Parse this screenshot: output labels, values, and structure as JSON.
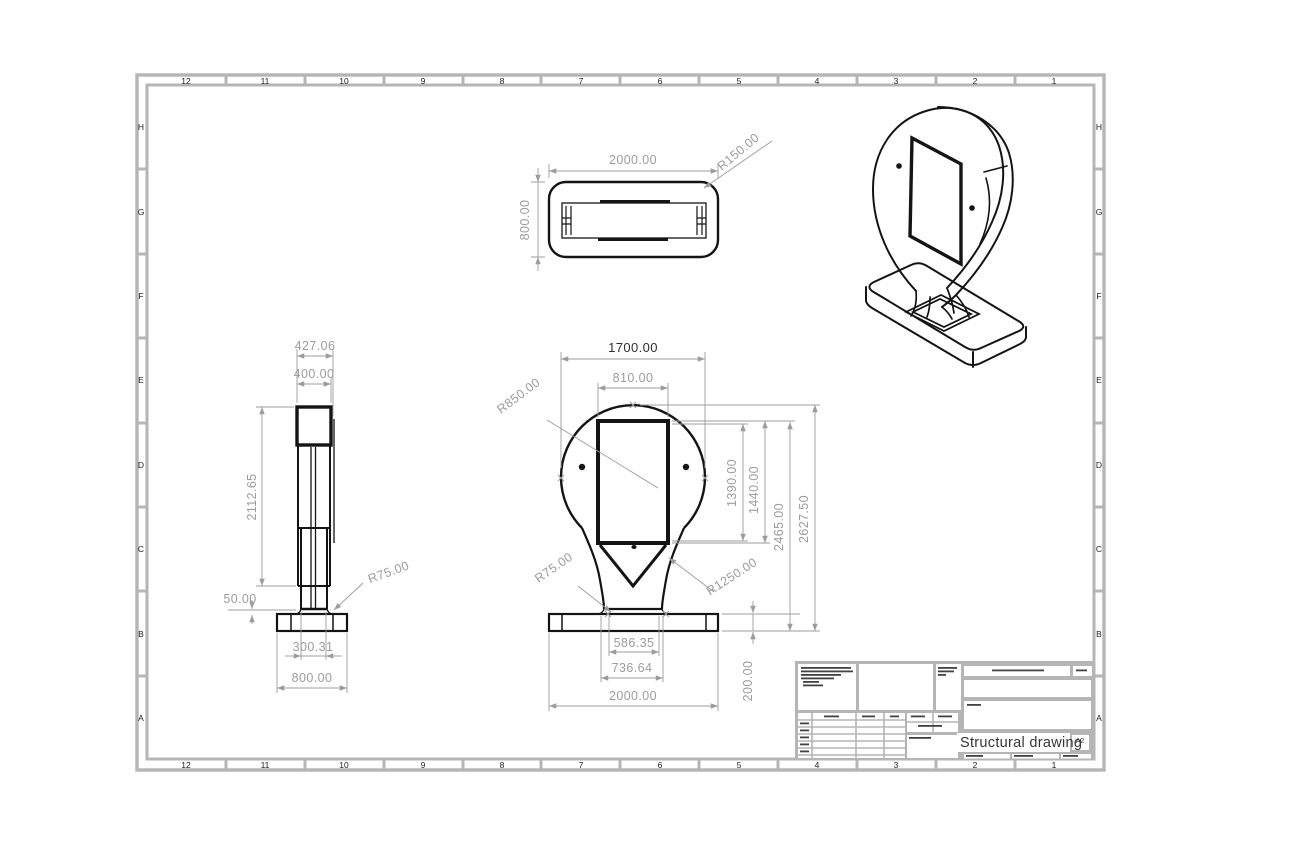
{
  "sheet": {
    "frame_color": "#b5b5b5",
    "zone_columns": [
      "12",
      "11",
      "10",
      "9",
      "8",
      "7",
      "6",
      "5",
      "4",
      "3",
      "2",
      "1"
    ],
    "zone_rows": [
      "H",
      "G",
      "F",
      "E",
      "D",
      "C",
      "B",
      "A"
    ]
  },
  "title_block": {
    "title": "Structural drawing",
    "size_code": "A2"
  },
  "dimensions": {
    "top_view": {
      "width": "2000.00",
      "depth": "800.00",
      "corner_radius": "R150.00"
    },
    "side_view": {
      "overall_width": "427.06",
      "head_width": "400.00",
      "column_height": "2112.65",
      "fillet_offset": "50.00",
      "fillet_radius": "R75.00",
      "column_width": "300.31",
      "base_width": "800.00"
    },
    "front_view": {
      "head_width": "1700.00",
      "screen_width": "810.00",
      "head_radius": "R850.00",
      "screen_opening_height": "1390.00",
      "screen_height": "1440.00",
      "height_to_screen_top": "2465.00",
      "overall_height": "2627.50",
      "fillet_radius": "R75.00",
      "neck_radius": "R1250.00",
      "neck_width": "586.35",
      "neck_base_width": "736.64",
      "base_width": "2000.00",
      "base_height": "200.00"
    }
  }
}
